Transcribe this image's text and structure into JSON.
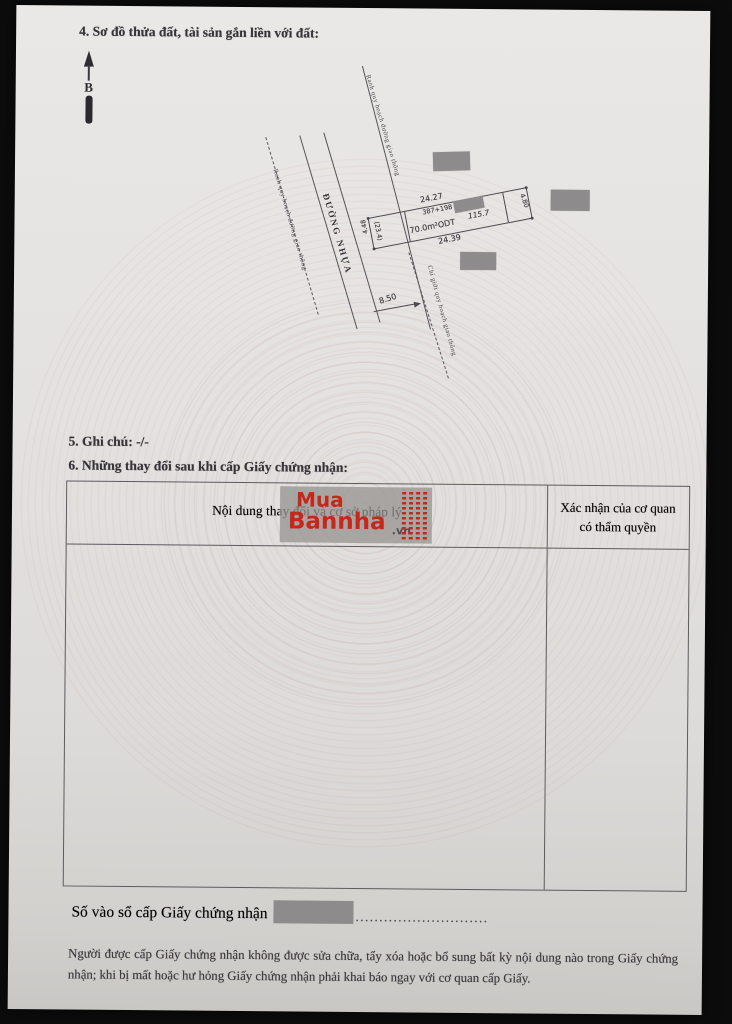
{
  "document": {
    "section4_heading": "4. Sơ đồ thửa đất, tài sản gắn liền với đất:",
    "section5_heading": "5. Ghi chú: -/-",
    "section6_heading": "6. Những thay đổi sau khi cấp Giấy chứng nhận:"
  },
  "diagram": {
    "north_label": "B",
    "road_name": "ĐƯỜNG NHỰA",
    "boundary_label_top": "Ranh quy hoạch đường giao thông",
    "boundary_label_left": "Ranh quy hoạch đường giao thông",
    "red_line_label": "Chỉ giới quy hoạch giao thông",
    "road_width": "8.50",
    "parcel": {
      "edge_top": "24.27",
      "edge_bottom": "24.39",
      "edge_left": "4.48",
      "edge_right": "4.80",
      "sub_left": "(23.4)",
      "plot_ref": "387+198",
      "area_alt": "115.7",
      "area_main": "70.0m²ODT"
    }
  },
  "changes_table": {
    "col1_header": "Nội dung thay đổi và cơ sở pháp lý",
    "col2_header_line1": "Xác nhận của cơ quan",
    "col2_header_line2": "có thẩm quyền"
  },
  "watermark": {
    "word1": "Mua",
    "word2": "Bannha",
    "domain": ".vn"
  },
  "footer": {
    "serial_label": "Số vào sổ cấp Giấy chứng nhận",
    "dotted": "............................",
    "notice": "Người được cấp Giấy chứng nhận không được sửa chữa, tẩy xóa hoặc bổ sung bất kỳ nội dung nào trong Giấy chứng nhận; khi bị mất hoặc hư hỏng Giấy chứng nhận phải khai báo ngay với cơ quan cấp Giấy."
  },
  "colors": {
    "watermark_red": "#c5271a",
    "redaction_gray": "#8d8b8b",
    "paper": "#e3e1df"
  }
}
